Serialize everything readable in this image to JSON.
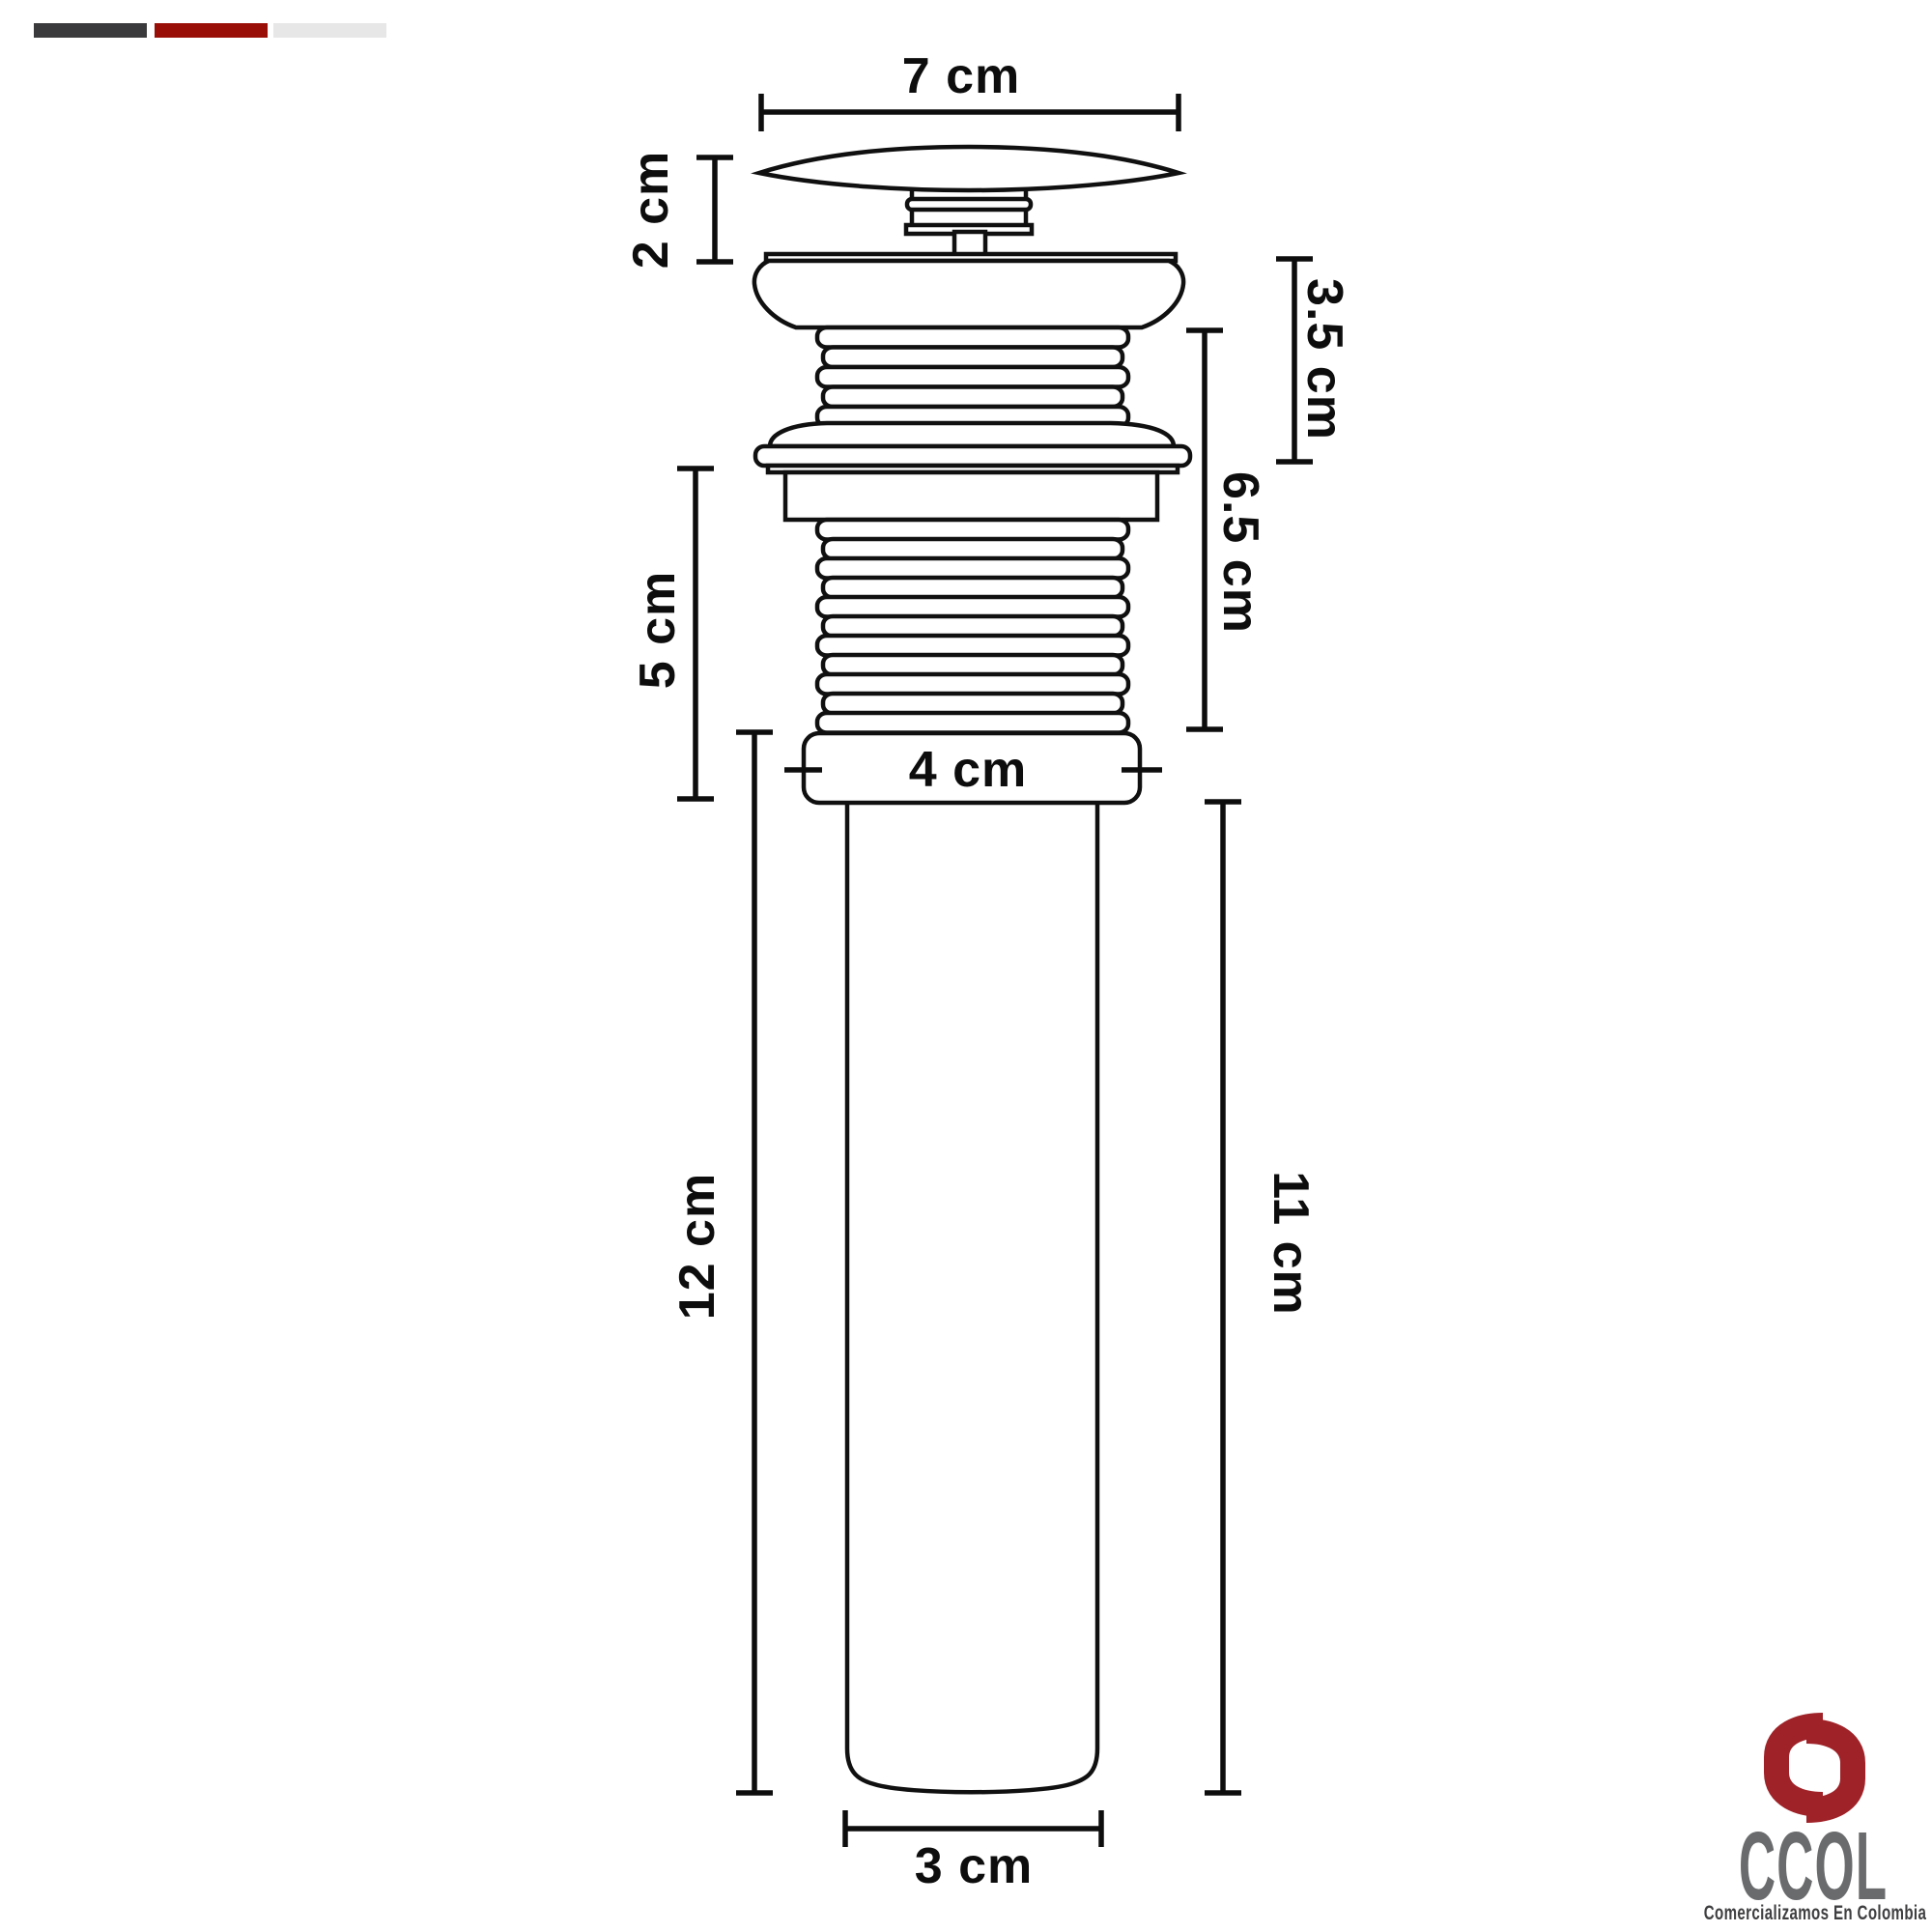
{
  "brand_bars": {
    "items": [
      {
        "name": "bar-dark",
        "color": "#3a3a3c"
      },
      {
        "name": "bar-red",
        "color": "#990e07"
      },
      {
        "name": "bar-light",
        "color": "#e8e7e7"
      }
    ]
  },
  "diagram": {
    "labels": {
      "cap_diameter": "7 cm",
      "cap_height": "2 cm",
      "upper_body_height": "3.5 cm",
      "body_to_collar_height": "6.5 cm",
      "lower_thread_height": "5 cm",
      "collar_width": "4 cm",
      "tailpipe_length_left": "12 cm",
      "tailpipe_length_right": "11 cm",
      "tailpipe_diameter": "3 cm"
    }
  },
  "logo": {
    "wordmark": "CCOL",
    "tagline": "Comercializamos En Colombia",
    "colors": {
      "red": "#9f2228",
      "gray": "#6a6b6d",
      "tagline": "#3f3f41"
    }
  }
}
